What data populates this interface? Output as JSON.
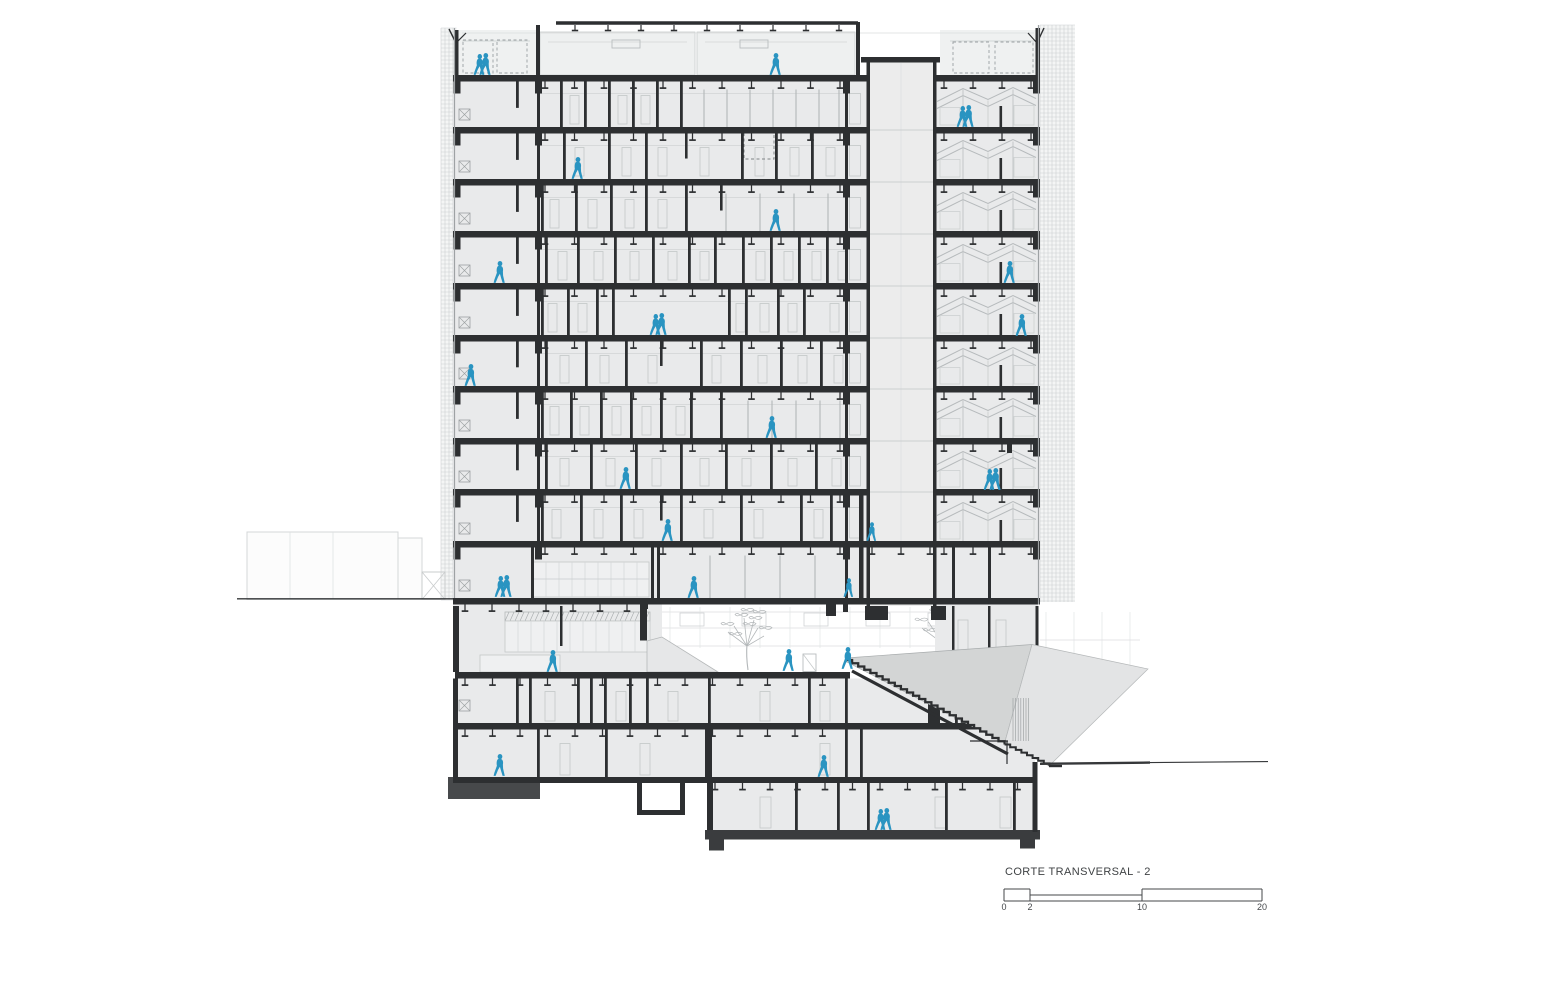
{
  "title": "CORTE TRANSVERSAL - 2",
  "scale_bar": {
    "labels": [
      "0",
      "2",
      "10",
      "20"
    ],
    "x": [
      1004,
      1030,
      1142,
      1262
    ],
    "y_top": 889,
    "y_mid": 895,
    "y_bottom": 901,
    "label_y": 902
  },
  "colors": {
    "wall": "#2d2f31",
    "slab": "#2d2f31",
    "heavy": "#47494b",
    "darkslab": "#3a3c3e",
    "room": "#e9eaeb",
    "roofzone": "#eff1f1",
    "core_fill": "#ececec",
    "box": "#eef0f0",
    "light": "#c6cacc",
    "lighter": "#d8dadb",
    "faint": "#e2e4e5",
    "mull": "#b2b6b8",
    "grid": "#ccd0d1",
    "edge": "#9ea2a4",
    "dash": "#9aa0a2",
    "figure": "#2a94c1",
    "massA": "#d3d5d5",
    "massB": "#e3e4e5",
    "tree": "#b3b7b9",
    "ground": "#36383a",
    "text": "#44474a",
    "hatch": "#a4a8aa"
  },
  "tower": {
    "x": 453,
    "right": 1040,
    "top": 28,
    "slabs": [
      75,
      127,
      179,
      231,
      283,
      335,
      386,
      438,
      489,
      541
    ],
    "slab_th": 6.5,
    "ground_slab": 598,
    "core": {
      "left": 866.5,
      "right": 933,
      "wall": 3.5,
      "top": 57,
      "bottom": 606,
      "cap_x": 861,
      "cap_w": 79
    },
    "bay_wall_x": 537,
    "partial_wall_x": 516,
    "sliver_wall_x": 845,
    "capitals": [
      457,
      538.5,
      846.5,
      1036.5
    ],
    "hangers": {
      "start": 545,
      "end": 858,
      "step": 29.5,
      "right_start": 944,
      "right_end": 1032,
      "right_step": 29
    },
    "floors": [
      {
        "full": [
          560,
          584,
          608,
          632,
          656,
          680
        ],
        "stub": [],
        "mull": [
          704,
          727,
          750,
          773,
          796,
          819,
          839
        ],
        "doors": [
          570,
          618,
          641
        ]
      },
      {
        "full": [
          563,
          608,
          645,
          741,
          775,
          811
        ],
        "stub": [
          685
        ],
        "mull": [],
        "doors": [
          575,
          622,
          658,
          700,
          755,
          790,
          826
        ],
        "dashed": [
          744,
          132,
          30,
          27
        ]
      },
      {
        "full": [
          541,
          575,
          610,
          645,
          685
        ],
        "stub": [
          720
        ],
        "mull": [
          726,
          760,
          794,
          828
        ],
        "doors": [
          550,
          588,
          625,
          658
        ]
      },
      {
        "full": [
          545,
          577,
          614,
          652,
          688,
          714,
          742,
          770,
          798,
          826
        ],
        "stub": [],
        "mull": [],
        "doors": [
          558,
          594,
          630,
          668,
          700,
          756,
          784,
          812,
          838
        ]
      },
      {
        "full": [
          541,
          567,
          596,
          612,
          728,
          745,
          777,
          803
        ],
        "stub": [],
        "mull": [],
        "doors": [
          548,
          578,
          736,
          760,
          788,
          830
        ]
      },
      {
        "full": [
          545,
          585,
          625,
          700,
          740,
          780,
          820
        ],
        "stub": [
          660
        ],
        "mull": [],
        "doors": [
          560,
          600,
          648,
          712,
          758,
          798,
          834
        ]
      },
      {
        "full": [
          541,
          570,
          600,
          630,
          660,
          690,
          720
        ],
        "stub": [],
        "mull": [
          748,
          772,
          796,
          820,
          840
        ],
        "doors": [
          550,
          580,
          612,
          642,
          676
        ]
      },
      {
        "full": [
          545,
          590,
          635,
          680,
          725,
          770,
          815
        ],
        "stub": [],
        "mull": [],
        "doors": [
          560,
          606,
          652,
          700,
          742,
          788,
          832
        ],
        "extra_stub": [
          1007,
          444,
          5,
          9
        ]
      },
      {
        "full": [
          541,
          580,
          620,
          680,
          740,
          800,
          830
        ],
        "stub": [
          660
        ],
        "mull": [],
        "doors": [
          552,
          594,
          634,
          704,
          754,
          814
        ]
      }
    ],
    "ground_floor": {
      "full": [
        531,
        651,
        657,
        845,
        952,
        988
      ],
      "mullions": [
        710,
        745,
        780,
        815
      ],
      "counter": [
        533,
        562,
        116,
        35
      ]
    },
    "right_bay": {
      "x": 935,
      "stub_x": 999.5
    }
  },
  "roof": {
    "canopy": {
      "x1": 556,
      "x2": 858,
      "y": 23,
      "w": 3.5
    },
    "canopy_hangers": [
      575,
      608,
      641,
      674,
      707,
      740,
      773,
      806,
      839
    ],
    "posts": [
      [
        536,
        25,
        4,
        50
      ],
      [
        856,
        22,
        4,
        53
      ]
    ],
    "parapets": [
      [
        454,
        30,
        4.5,
        45
      ],
      [
        1035.5,
        28,
        4.5,
        47
      ]
    ],
    "flags": [
      [
        456,
        43,
        449,
        29,
        466,
        33
      ],
      [
        1037,
        43,
        1044,
        28,
        1028,
        33
      ]
    ],
    "boxes": [
      [
        540,
        32,
        155,
        43
      ],
      [
        697,
        32,
        158,
        43
      ]
    ],
    "vents": [
      [
        612,
        40,
        28,
        8
      ],
      [
        740,
        40,
        28,
        8
      ]
    ],
    "planters": [
      [
        463,
        40,
        30,
        33
      ],
      [
        497,
        40,
        30,
        33
      ],
      [
        953,
        42,
        36,
        31
      ],
      [
        995,
        42,
        38,
        31
      ]
    ],
    "terraces": [
      [
        456,
        30,
        80,
        45
      ],
      [
        940,
        30,
        96,
        45
      ]
    ]
  },
  "podium": {
    "interior": {
      "x": 453,
      "y": 604.5,
      "w": 209,
      "h": 67.5
    },
    "court_slab_y": 672,
    "court_slab_th": 6.5,
    "interior_walls": [
      [
        453,
        606,
        6,
        66
      ],
      [
        560,
        606,
        2.5,
        40
      ],
      [
        640,
        604.5,
        7,
        36
      ]
    ],
    "shelf": {
      "x": 505,
      "y": 612,
      "w": 145,
      "hatch_h": 9,
      "body_h": 31
    },
    "counter": [
      480,
      655,
      80,
      17
    ],
    "wedge": [
      [
        647,
        641
      ],
      [
        662,
        637
      ],
      [
        718,
        672
      ],
      [
        647,
        672
      ]
    ],
    "balustrade": [
      803,
      654,
      13,
      17.5
    ],
    "rb_rooms": {
      "x": 935,
      "y": 604.5,
      "w": 103,
      "h": 68,
      "walls": [
        952,
        988
      ],
      "doors": [
        958,
        996
      ]
    },
    "core_stubs": [
      [
        865,
        606,
        23,
        14
      ],
      [
        931,
        606,
        15,
        14
      ],
      [
        826,
        604,
        10,
        12
      ],
      [
        843,
        604,
        5,
        8
      ],
      [
        640,
        604,
        8,
        5
      ]
    ]
  },
  "basement": {
    "b1": {
      "y": 678.5,
      "h": 44.5,
      "x": 453,
      "w": 582,
      "walls": [
        516,
        529,
        577,
        590,
        604,
        629,
        646,
        708,
        808,
        845,
        955
      ],
      "doors": [
        545,
        616,
        668,
        760,
        820
      ],
      "slab_y": 723
    },
    "b2": {
      "y": 729.5,
      "h": 47.5,
      "walls": [
        537,
        605,
        845,
        860
      ],
      "thick": [
        705,
        729.5,
        7,
        53.5
      ],
      "doors": [
        560,
        640,
        820
      ],
      "slab_y": 777
    },
    "b3": {
      "y": 783,
      "h": 47,
      "x": 707,
      "w": 330,
      "walls": [
        795,
        837,
        867,
        945,
        1013
      ],
      "doors": [
        760,
        935,
        1000
      ],
      "bottom_y": 830,
      "bottom_h": 9.5
    },
    "heavy_block": [
      448,
      777,
      92,
      22
    ],
    "pit": {
      "x": 637,
      "y": 783,
      "w": 48,
      "depth": 27
    },
    "piers": [
      [
        709,
        839.5,
        15,
        11
      ],
      [
        1020,
        839.5,
        15,
        9
      ]
    ],
    "right_wall": [
      1032.5,
      762,
      5,
      70
    ],
    "dark_door": [
      928,
      700,
      12,
      23
    ],
    "marker_b1": [
      459,
      700,
      11,
      11
    ]
  },
  "stairs": {
    "main": {
      "x": 846,
      "y": 660,
      "n": 26,
      "dx": 6.1,
      "dy": 3.25
    },
    "lower": {
      "x": 1004.6,
      "y": 744.5,
      "n": 8,
      "dx": 5.6,
      "dy": 2.7
    },
    "underside": [
      852,
      671,
      1008,
      754
    ],
    "rail": {
      "h": [
        970,
        741,
        1008
      ],
      "post": [
        1007,
        741,
        764
      ]
    }
  },
  "masses": {
    "A": [
      [
        846,
        658
      ],
      [
        1032,
        644.5
      ],
      [
        1004.6,
        743
      ],
      [
        846,
        661.5
      ]
    ],
    "B": [
      [
        1032,
        644.5
      ],
      [
        1148,
        669
      ],
      [
        1049,
        766
      ],
      [
        1004.6,
        743
      ]
    ],
    "hatch": {
      "x1": 1013,
      "x2": 1031,
      "step": 2.6,
      "y1": 698,
      "y2": 741
    }
  },
  "site": {
    "ground_left": [
      237,
      598.8,
      453
    ],
    "ground_right": [
      [
        1040,
        763.8,
        1150,
        762.6
      ],
      [
        1150,
        762.6,
        1268,
        761.6
      ]
    ],
    "left_building": {
      "main": [
        247,
        532,
        151,
        67.5
      ],
      "annex": [
        398,
        538,
        24,
        61.5
      ],
      "xbay": [
        422,
        572,
        23,
        27.5
      ],
      "inner_v": [
        290,
        333
      ]
    },
    "bg_rows": {
      "x1": 660,
      "x2": 1035,
      "ys": [
        612,
        628,
        646
      ],
      "v_step": 30,
      "v_y1": 607,
      "v_y2": 648
    },
    "bg_windows": {
      "x0": 680,
      "step": 62,
      "n": 6,
      "y": 613,
      "w": 24,
      "h": 13
    },
    "right_elev": {
      "x1": 1046,
      "x2": 1138,
      "step": 28,
      "y1": 612,
      "y2": 668,
      "hline_y": 640
    },
    "trees": [
      {
        "x": 748,
        "y": 670,
        "s": 1.0
      },
      {
        "x": 943,
        "y": 668,
        "s": 1.05
      },
      {
        "x": 1010,
        "y": 667,
        "s": 0.75
      }
    ],
    "grids": [
      {
        "x": 441,
        "y": 28,
        "w": 15.5,
        "h": 572,
        "step": 4
      },
      {
        "x": 1040,
        "y": 25,
        "w": 35,
        "h": 577,
        "step": 4
      }
    ]
  },
  "figures": [
    {
      "x": 483,
      "y": 75,
      "kind": "pair"
    },
    {
      "x": 776,
      "y": 75,
      "kind": "single"
    },
    {
      "x": 966,
      "y": 127,
      "kind": "pair"
    },
    {
      "x": 578,
      "y": 179,
      "kind": "single"
    },
    {
      "x": 776,
      "y": 231,
      "kind": "single"
    },
    {
      "x": 500,
      "y": 283,
      "kind": "single"
    },
    {
      "x": 1010,
      "y": 283,
      "kind": "single"
    },
    {
      "x": 659,
      "y": 335,
      "kind": "pair"
    },
    {
      "x": 1022,
      "y": 336,
      "kind": "single"
    },
    {
      "x": 471,
      "y": 386,
      "kind": "single"
    },
    {
      "x": 772,
      "y": 438,
      "kind": "single"
    },
    {
      "x": 626,
      "y": 489,
      "kind": "single"
    },
    {
      "x": 993,
      "y": 490,
      "kind": "pair"
    },
    {
      "x": 668,
      "y": 541,
      "kind": "single"
    },
    {
      "x": 872,
      "y": 541,
      "kind": "single",
      "s": 0.85
    },
    {
      "x": 504,
      "y": 597,
      "kind": "pair"
    },
    {
      "x": 694,
      "y": 598,
      "kind": "single"
    },
    {
      "x": 849,
      "y": 597,
      "kind": "single",
      "s": 0.85
    },
    {
      "x": 553,
      "y": 672,
      "kind": "single"
    },
    {
      "x": 789,
      "y": 671,
      "kind": "single"
    },
    {
      "x": 848,
      "y": 669,
      "kind": "single"
    },
    {
      "x": 500,
      "y": 776,
      "kind": "single"
    },
    {
      "x": 824,
      "y": 777,
      "kind": "single"
    },
    {
      "x": 884,
      "y": 830,
      "kind": "pair"
    }
  ]
}
